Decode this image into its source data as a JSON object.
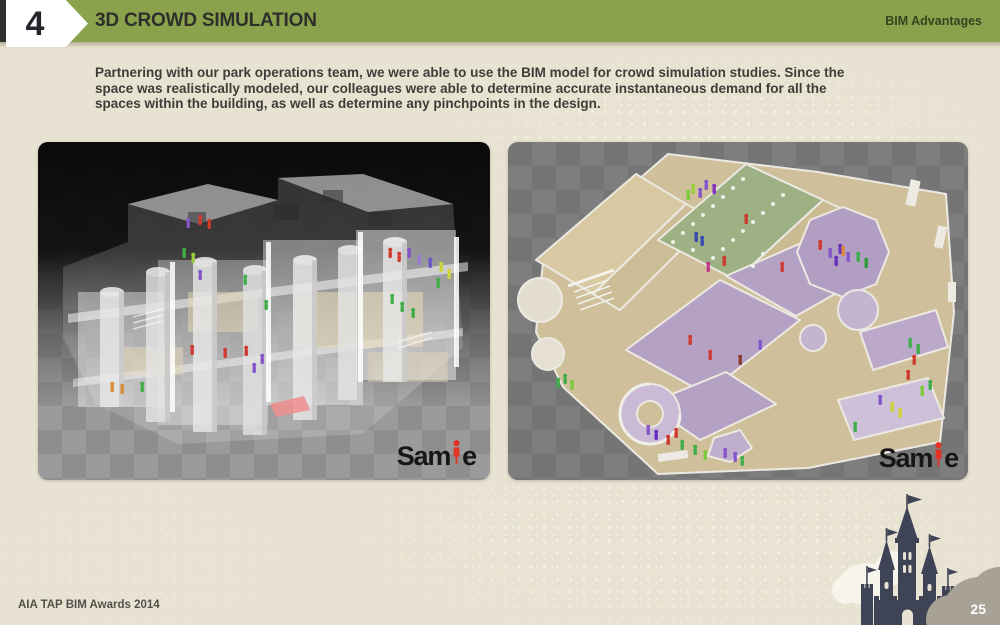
{
  "colors": {
    "header_green": "#8ba24d",
    "header_edge_dark": "#30322f",
    "badge_white": "#ffffff",
    "slide_number_dark": "#24262b",
    "title_dark": "#2e2f2a",
    "section_dark": "#37431f",
    "page_background": "#e8e2d2",
    "body_text": "#3e3d39",
    "footer_text": "#52504a",
    "castle_navy": "#3e4356",
    "cloud_gray": "#a8a296",
    "cloud_white": "#f7f4eb",
    "watermark_black": "#161616",
    "watermark_red": "#e23327",
    "page_number_white": "#ffffff"
  },
  "header": {
    "slide_number": "4",
    "title": "3D CROWD SIMULATION",
    "section_label": "BIM Advantages"
  },
  "body": {
    "line1": "Partnering with our park operations team, we were able to use the BIM model for crowd simulation studies. Since the",
    "line2": "space was realistically modeled, our colleagues were able to determine accurate instantaneous demand for all the",
    "line3": "spaces within the building, as well as determine any pinchpoints in the design."
  },
  "images": {
    "left": {
      "watermark_pre": "Sam",
      "watermark_post": "e",
      "watermark_icon": "person-icon"
    },
    "right": {
      "watermark_pre": "Sam",
      "watermark_post": "e",
      "watermark_icon": "person-icon"
    }
  },
  "footer": {
    "credit": "AIA TAP BIM Awards 2014",
    "page_number": "25"
  }
}
